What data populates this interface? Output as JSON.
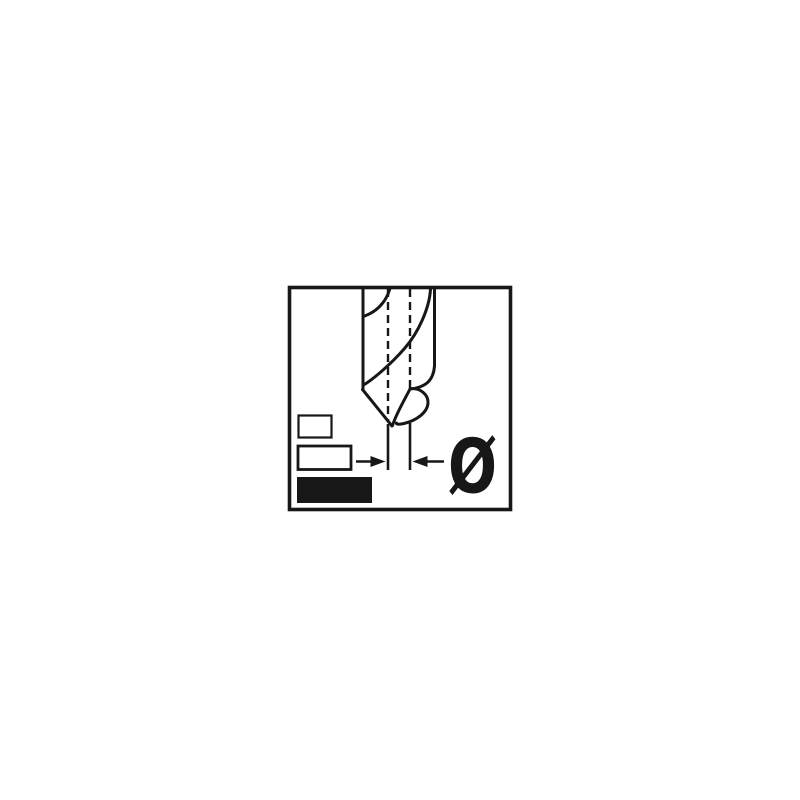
{
  "page": {
    "background_color": "#ffffff"
  },
  "figure": {
    "name": "drill-bit-diameter-pictogram",
    "diameter_symbol": "Ø",
    "colors": {
      "line": "#171717",
      "background": "#ffffff",
      "filled_box": "#171717"
    },
    "icons": [
      {
        "name": "drill-bit-icon",
        "style": "outline drawing, spiral flutes, cut by frame top"
      },
      {
        "name": "centre-dashline-left",
        "style": "dashed vertical line"
      },
      {
        "name": "centre-dashline-right",
        "style": "dashed vertical line"
      },
      {
        "name": "dimension-arrows-icon",
        "style": "two opposing solid arrowheads measuring tip width"
      },
      {
        "name": "diameter-symbol",
        "glyph": "Ø"
      },
      {
        "name": "size-box-small",
        "style": "outlined rectangle"
      },
      {
        "name": "size-box-medium",
        "style": "outlined rectangle"
      },
      {
        "name": "size-box-large",
        "style": "filled black rectangle"
      }
    ]
  }
}
